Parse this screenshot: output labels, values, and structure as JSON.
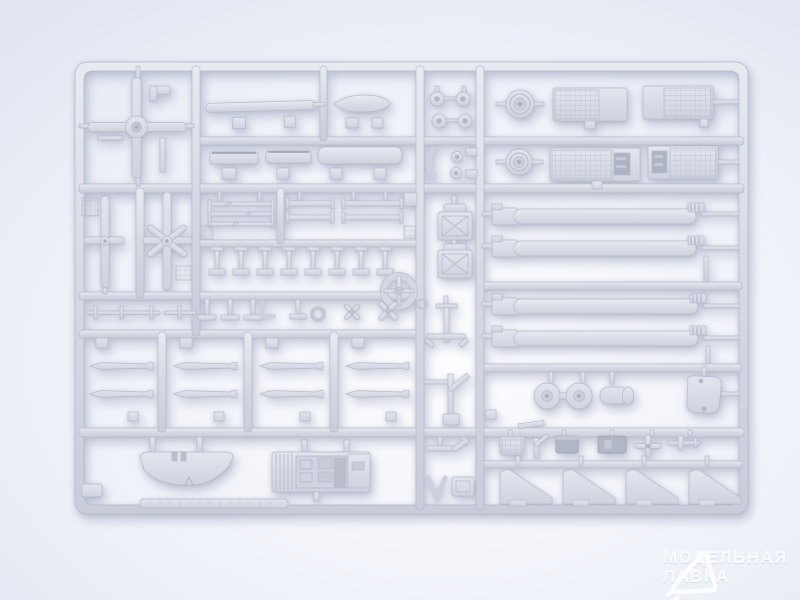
{
  "scene": {
    "subject": "Light grey injection-molded plastic model kit sprue (helicopter parts) photographed on a bright white backdrop",
    "orientation": "sprue fills frame, rounded-corner rectangular runner grid",
    "lighting": "soft studio light, brighter at lower center, soft shadow under sprue"
  },
  "colors": {
    "bg-center": "#fdfdff",
    "bg-mid": "#eef1f8",
    "bg-edge": "#d6daea",
    "plastic": "#d5d8e2",
    "plastic-light": "#e7eaf1",
    "plastic-dark": "#c6cad7",
    "plastic-edge": "#b6bbc9",
    "dark-part": "#b2b7c6",
    "watermark": "rgba(255,255,255,0.85)"
  },
  "sprue": {
    "material_color_name": "light grey",
    "parts": [
      {
        "name": "main-rotor-hub-with-blades",
        "count": 1
      },
      {
        "name": "tail-rotor",
        "count": 2
      },
      {
        "name": "main-rotor-blade-long",
        "count": 4
      },
      {
        "name": "pilot-seat",
        "count": 2
      },
      {
        "name": "road-wheel",
        "count": 2
      },
      {
        "name": "twin-wheel-bogie",
        "count": 1
      },
      {
        "name": "wheel-hub-disc",
        "count": 4
      },
      {
        "name": "radiator-grille-panel",
        "count": 4
      },
      {
        "name": "unguided-rocket",
        "count": 8
      },
      {
        "name": "stabilizer-wing",
        "count": 1
      },
      {
        "name": "cockpit-tub",
        "count": 1
      },
      {
        "name": "wedge-bracket",
        "count": 4
      },
      {
        "name": "fuel-tank-half",
        "count": 1
      },
      {
        "name": "exhaust-pipe",
        "count": 2
      },
      {
        "name": "rotor-hub-ring",
        "count": 1
      },
      {
        "name": "gearbox-housing",
        "count": 1
      },
      {
        "name": "antenna-rod-pin",
        "count": 8
      },
      {
        "name": "small-clamp",
        "count": 8
      },
      {
        "name": "cylinder-drum",
        "count": 1
      },
      {
        "name": "landing-gear-leg",
        "count": 2
      },
      {
        "name": "embossed-label-strip",
        "count": 1
      }
    ]
  },
  "watermark": {
    "logo": "paper-plane-triangle",
    "line1": "МОДЕЛЬНАЯ",
    "line2": "ЛАВКА"
  }
}
